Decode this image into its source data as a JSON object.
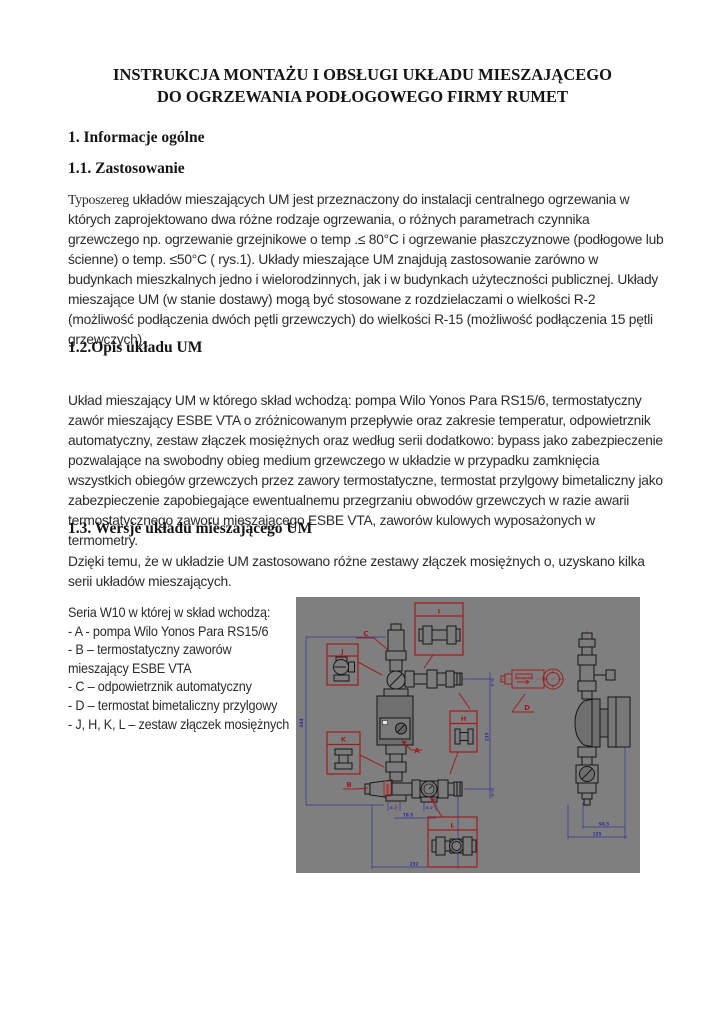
{
  "document": {
    "title_line_1": "INSTRUKCJA MONTAŻU I OBSŁUGI UKŁADU MIESZAJĄCEGO",
    "title_line_2": "DO OGRZEWANIA PODŁOGOWEGO FIRMY RUMET",
    "section_1_heading": "1. Informacje ogólne",
    "section_1_1_heading": "1.1. Zastosowanie",
    "section_1_1_first_word": "Typoszereg",
    "section_1_1_paragraph": " układów mieszających UM jest przeznaczony do instalacji centralnego ogrzewania w których zaprojektowano dwa różne rodzaje ogrzewania, o różnych parametrach czynnika grzewczego np. ogrzewanie grzejnikowe o temp .≤ 80°C i ogrzewanie płaszczyznowe (podłogowe lub ścienne) o temp. ≤50°C ( rys.1). Układy mieszające UM znajdują zastosowanie zarówno w budynkach mieszkalnych jedno i wielorodzinnych, jak i w budynkach użyteczności publicznej. Układy mieszające UM (w stanie dostawy) mogą być stosowane z rozdzielaczami o wielkości R-2 (możliwość podłączenia dwóch pętli grzewczych) do wielkości R-15 (możliwość podłączenia 15 pętli grzewczych).",
    "section_1_2_heading": "1.2.Opis układu UM",
    "section_1_2_paragraph": "Układ mieszający UM w którego skład wchodzą: pompa Wilo Yonos Para RS15/6, termostatyczny zawór mieszający ESBE VTA o zróżnicowanym przepływie oraz zakresie temperatur, odpowietrznik automatyczny, zestaw złączek mosiężnych oraz według serii dodatkowo: bypass jako zabezpieczenie pozwalające na swobodny obieg medium grzewczego w układzie w przypadku zamknięcia wszystkich obiegów grzewczych przez zawory termostatyczne, termostat przylgowy bimetaliczny jako zabezpieczenie zapobiegające ewentualnemu przegrzaniu obwodów grzewczych w razie awarii termostatycznego zaworu mieszającego ESBE VTA, zaworów kulowych wyposażonych w termometry.",
    "section_1_3_heading": "1.3. Wersje układu mieszającego UM",
    "section_1_3_paragraph": "Dzięki temu, że w układzie UM zastosowano różne zestawy złączek mosiężnych o, uzyskano kilka serii układów mieszających.",
    "series_lines": [
      "Seria W10 w której w skład wchodzą:",
      "- A - pompa Wilo Yonos Para RS15/6",
      "- B – termostatyczny zaworów",
      "mieszający ESBE VTA",
      "- C – odpowietrznik automatyczny",
      "- D – termostat bimetaliczny przylgowy",
      " - J, H, K, L – zestaw złączek mosiężnych"
    ]
  },
  "diagram": {
    "callouts": {
      "i": "I",
      "j": "J",
      "k": "K",
      "h": "H",
      "l": "L"
    },
    "parts": {
      "a": "A",
      "b": "B",
      "c": "C",
      "d": "D"
    },
    "dimensions": {
      "front_height": "344",
      "front_valve_spacing": "78.5",
      "front_total_width": "232",
      "front_right_height": "235",
      "thread_left": "G 1\"",
      "thread_right": "G 1\"",
      "thread_top": "G ½",
      "thread_bottom": "G ½",
      "side_width": "94.5",
      "side_total_width": "135"
    },
    "colors": {
      "background": "#7f7f7f",
      "annotation_red": "#a21c1c",
      "dimension_blue": "#34349c",
      "drawing_black": "#161616"
    }
  }
}
